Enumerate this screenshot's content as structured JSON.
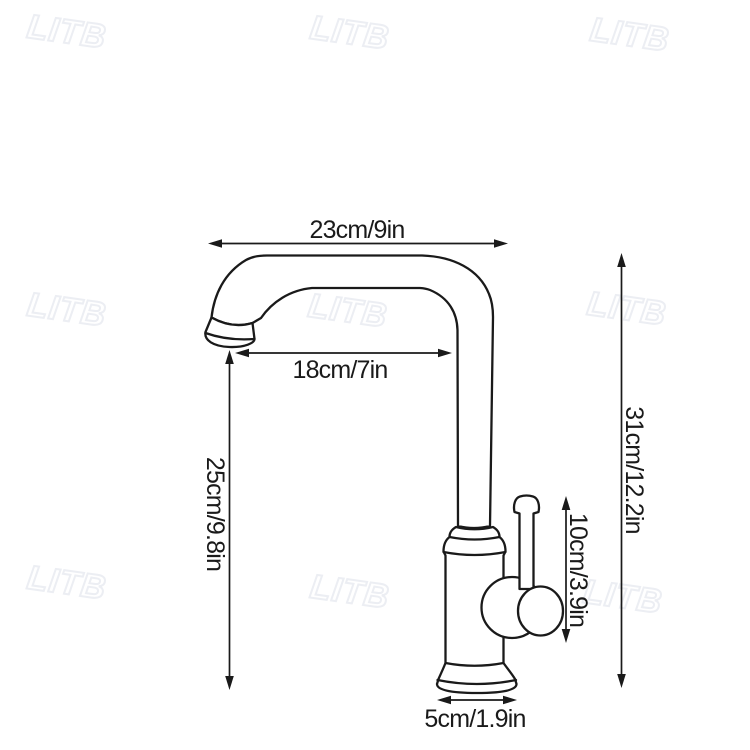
{
  "watermark": {
    "text": "LITB"
  },
  "diagram": {
    "subject": "kitchen faucet line drawing with dimensions",
    "dimensions": {
      "top_width": "23cm/9in",
      "spout_reach": "18cm/7in",
      "spout_height": "25cm/9.8in",
      "total_height": "31cm/12.2in",
      "handle_height": "10cm/3.9in",
      "base_width": "5cm/1.9in"
    },
    "colors": {
      "line": "#1a1a1a",
      "label_text": "#1a1a1a",
      "watermark_outline": "#eceef3",
      "background": "#ffffff"
    }
  }
}
